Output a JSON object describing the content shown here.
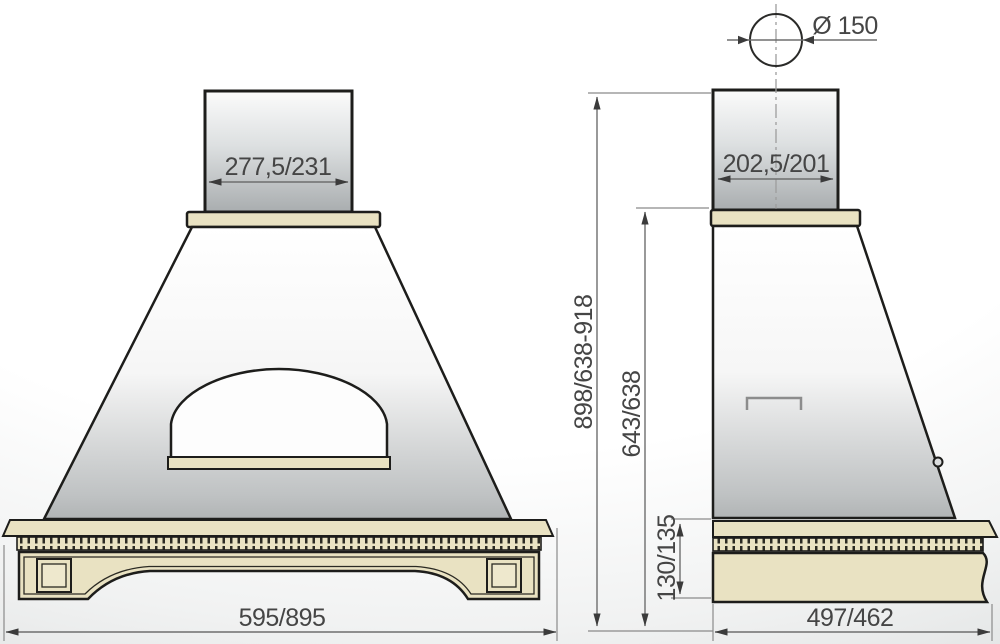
{
  "front_view": {
    "duct_width_label": "277,5/231",
    "overall_width_label": "595/895"
  },
  "side_view": {
    "duct_diameter_label": "Ø 150",
    "duct_depth_label": "202,5/201",
    "overall_depth_label": "497/462",
    "total_height_label": "898/638-918",
    "hood_height_label": "643/638",
    "base_height_label": "130/135"
  },
  "colors": {
    "wood_cream": "#e9e2c2",
    "outline": "#1d1d1b",
    "dimension_text": "#454545",
    "metal_gray": "#a9adaf"
  }
}
